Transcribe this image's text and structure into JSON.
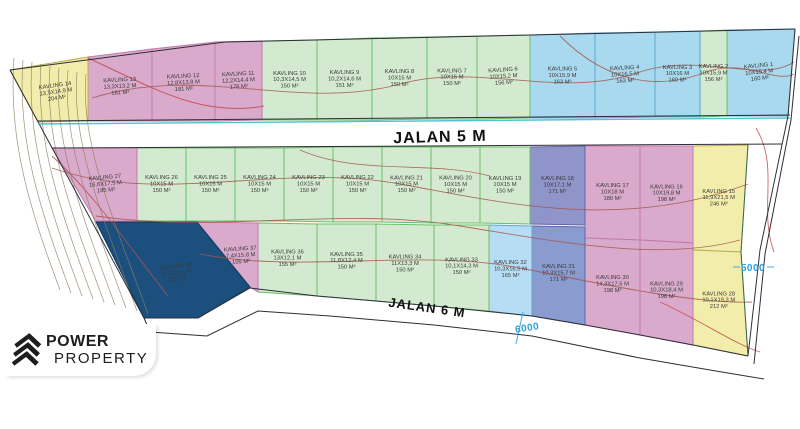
{
  "palette": {
    "yellow": {
      "fill": "#f2edaa",
      "stroke": "#b8ae4f"
    },
    "pink": {
      "fill": "#d9aacb",
      "stroke": "#c678ad"
    },
    "green": {
      "fill": "#d4ead0",
      "stroke": "#67c066"
    },
    "blue": {
      "fill": "#a9d9ee",
      "stroke": "#5aa7cf"
    },
    "skyblue": {
      "fill": "#b7ddf4",
      "stroke": "#5aa7cf"
    },
    "purple": {
      "fill": "#8f94c9",
      "stroke": "#5f64a8"
    },
    "purple2": {
      "fill": "#8a9bd0",
      "stroke": "#5f64a8"
    },
    "navy": {
      "fill": "#1b4f7e",
      "stroke": "#123a5e"
    },
    "contour_brown": "#a2584b",
    "contour_red": "#c14a4a",
    "contour_gray": "#8d7f63",
    "cyan_line": "#35b6c8",
    "dim_blue": "#2b9fd6"
  },
  "roads": {
    "jalan5": "JALAN 5 M",
    "jalan6": "JALAN 6 M"
  },
  "dimensions": {
    "d5000": "5000",
    "d6000": "6000"
  },
  "logo": {
    "line1": "POWER",
    "line2": "PROPERTY"
  },
  "plots": [
    {
      "name": "KAVLING 1",
      "dims": "10X15,4 M",
      "area": "160 M²",
      "color": "blue",
      "poly": "727,30 795,29 788,116 727,116",
      "rot": -6
    },
    {
      "name": "KAVLING 2",
      "dims": "10X15,9 M",
      "area": "156 M²",
      "color": "green",
      "poly": "700,31 727,30 727,116 700,117",
      "rot": 0
    },
    {
      "name": "KAVLING 3",
      "dims": "10X16 M",
      "area": "160 M²",
      "color": "blue",
      "poly": "655,32 700,31 700,117 655,117",
      "rot": 0
    },
    {
      "name": "KAVLING 4",
      "dims": "10X16,5 M",
      "area": "163 M²",
      "color": "blue",
      "poly": "595,33 655,32 655,117 595,118",
      "rot": -3
    },
    {
      "name": "KAVLING 5",
      "dims": "10X15,9 M",
      "area": "163 M²",
      "color": "blue",
      "poly": "530,35 595,33 595,118 530,118",
      "rot": 0
    },
    {
      "name": "KAVLING 6",
      "dims": "10X15,2 M",
      "area": "156 M²",
      "color": "green",
      "poly": "477,36 530,35 530,118 477,119",
      "rot": -4
    },
    {
      "name": "KAVLING 7",
      "dims": "10X15 M",
      "area": "150 M²",
      "color": "green",
      "poly": "427,37 477,36 477,119 427,119",
      "rot": 0
    },
    {
      "name": "KAVLING 8",
      "dims": "10X15 M",
      "area": "150 M²",
      "color": "green",
      "poly": "372,38 427,37 427,119 372,120",
      "rot": 0
    },
    {
      "name": "KAVLING 9",
      "dims": "10,2X14,6 M",
      "area": "151 M²",
      "color": "green",
      "poly": "317,40 372,38 372,120 317,120",
      "rot": 0
    },
    {
      "name": "KAVLING 10",
      "dims": "10,3X14,5 M",
      "area": "150 M²",
      "color": "green",
      "poly": "262,41 317,40 317,120 262,120",
      "rot": 0
    },
    {
      "name": "KAVLING 11",
      "dims": "12,2X14,4 M",
      "area": "178 M²",
      "color": "pink",
      "poly": "215,42 262,41 262,120 215,121",
      "rot": -3
    },
    {
      "name": "KAVLING 12",
      "dims": "12,8X13,8 M",
      "area": "181 M²",
      "color": "pink",
      "poly": "152,49 215,42 215,121 152,121",
      "rot": -3
    },
    {
      "name": "KAVLING 13",
      "dims": "13,3X13,2 M",
      "area": "181 M²",
      "color": "pink",
      "poly": "88,57 152,49 152,121 88,121",
      "rot": -3
    },
    {
      "name": "KAVLING 14",
      "dims": "13,5X14,9 M",
      "area": "204 M²",
      "color": "yellow",
      "poly": "10,70 88,57 88,121 38,122",
      "rot": -8
    },
    {
      "name": "KAVLING 15",
      "dims": "11,9X21,5 M",
      "area": "246 M²",
      "color": "yellow",
      "poly": "693,146 748,145 741,252 693,250",
      "rot": 0
    },
    {
      "name": "KAVLING 16",
      "dims": "10X19,8 M",
      "area": "198 M²",
      "color": "pink",
      "poly": "640,146 693,146 693,243 640,240",
      "rot": 0
    },
    {
      "name": "KAVLING 17",
      "dims": "10X18 M",
      "area": "180 M²",
      "color": "pink",
      "poly": "585,146 640,146 640,240 585,238",
      "rot": 0
    },
    {
      "name": "KAVLING 18",
      "dims": "10X17,1 M",
      "area": "171 M²",
      "color": "purple",
      "poly": "530,147 585,146 585,225 530,224",
      "rot": 0
    },
    {
      "name": "KAVLING 19",
      "dims": "10X15 M",
      "area": "150 M²",
      "color": "green",
      "poly": "480,147 530,147 530,224 480,223",
      "rot": 0
    },
    {
      "name": "KAVLING 20",
      "dims": "10X15 M",
      "area": "150 M²",
      "color": "green",
      "poly": "431,147 480,147 480,223 431,223",
      "rot": 0
    },
    {
      "name": "KAVLING 21",
      "dims": "10X15 M",
      "area": "150 M²",
      "color": "green",
      "poly": "382,147 431,147 431,223 382,222",
      "rot": 0
    },
    {
      "name": "KAVLING 22",
      "dims": "10X15 M",
      "area": "150 M²",
      "color": "green",
      "poly": "333,147 382,147 382,222 333,222",
      "rot": 0
    },
    {
      "name": "KAVLING 23",
      "dims": "10X15 M",
      "area": "150 M²",
      "color": "green",
      "poly": "284,148 333,147 333,222 284,221",
      "rot": 0
    },
    {
      "name": "KAVLING 24",
      "dims": "10X15 M",
      "area": "150 M²",
      "color": "green",
      "poly": "235,148 284,148 284,221 235,221",
      "rot": 0
    },
    {
      "name": "KAVLING 25",
      "dims": "10X15 M",
      "area": "150 M²",
      "color": "green",
      "poly": "186,148 235,148 235,221 186,221",
      "rot": 0
    },
    {
      "name": "KAVLING 26",
      "dims": "10X15 M",
      "area": "150 M²",
      "color": "green",
      "poly": "137,148 186,148 186,221 137,221",
      "rot": 0
    },
    {
      "name": "KAVLING 27",
      "dims": "16,6X17,5 M",
      "area": "185 M²",
      "color": "pink",
      "poly": "52,148 137,148 137,221 96,221",
      "rot": -5
    },
    {
      "name": "KAVLING 28",
      "dims": "10,1X19,3 M",
      "area": "212 M²",
      "color": "yellow",
      "poly": "693,250 741,252 748,356 693,345",
      "rot": 0
    },
    {
      "name": "KAVLING 29",
      "dims": "10,3X18,4 M",
      "area": "198 M²",
      "color": "pink",
      "poly": "640,240 693,243 693,345 640,335",
      "rot": 0
    },
    {
      "name": "KAVLING 30",
      "dims": "14,3X17,5 M",
      "area": "198 M²",
      "color": "pink",
      "poly": "585,238 640,240 640,335 585,325",
      "rot": 0
    },
    {
      "name": "KAVLING 31",
      "dims": "10,3X15,7 M",
      "area": "171 M²",
      "color": "purple2",
      "poly": "532,226 585,227 585,325 532,316",
      "rot": 0
    },
    {
      "name": "KAVLING 32",
      "dims": "10,3X16,5 M",
      "area": "165 M²",
      "color": "skyblue",
      "poly": "489,225 532,226 532,316 489,311",
      "rot": 0
    },
    {
      "name": "KAVLING 33",
      "dims": "10,1X14,3 M",
      "area": "150 M²",
      "color": "green",
      "poly": "434,225 489,225 489,311 434,306",
      "rot": 0
    },
    {
      "name": "KAVLING 34",
      "dims": "11X13,3 M",
      "area": "150 M²",
      "color": "green",
      "poly": "376,224 434,225 434,306 376,301",
      "rot": 0
    },
    {
      "name": "KAVLING 35",
      "dims": "11,8X12,4 M",
      "area": "150 M²",
      "color": "green",
      "poly": "317,224 376,224 376,301 317,296",
      "rot": 0
    },
    {
      "name": "KAVLING 36",
      "dims": "13X12,1 M",
      "area": "155 M²",
      "color": "green",
      "poly": "258,223 317,224 317,296 258,292",
      "rot": 0
    },
    {
      "name": "KAVLING 37",
      "dims": "7,4X15,8 M",
      "area": "105 M²",
      "color": "pink",
      "poly": "197,222 258,223 258,292 250,287",
      "rot": -4
    },
    {
      "name": "KAVLING 38",
      "dims": "6,5X22,4 M",
      "area": "202 M²",
      "color": "navy",
      "poly": "96,222 197,222 250,287 198,318 144,318",
      "rot": -8
    }
  ]
}
